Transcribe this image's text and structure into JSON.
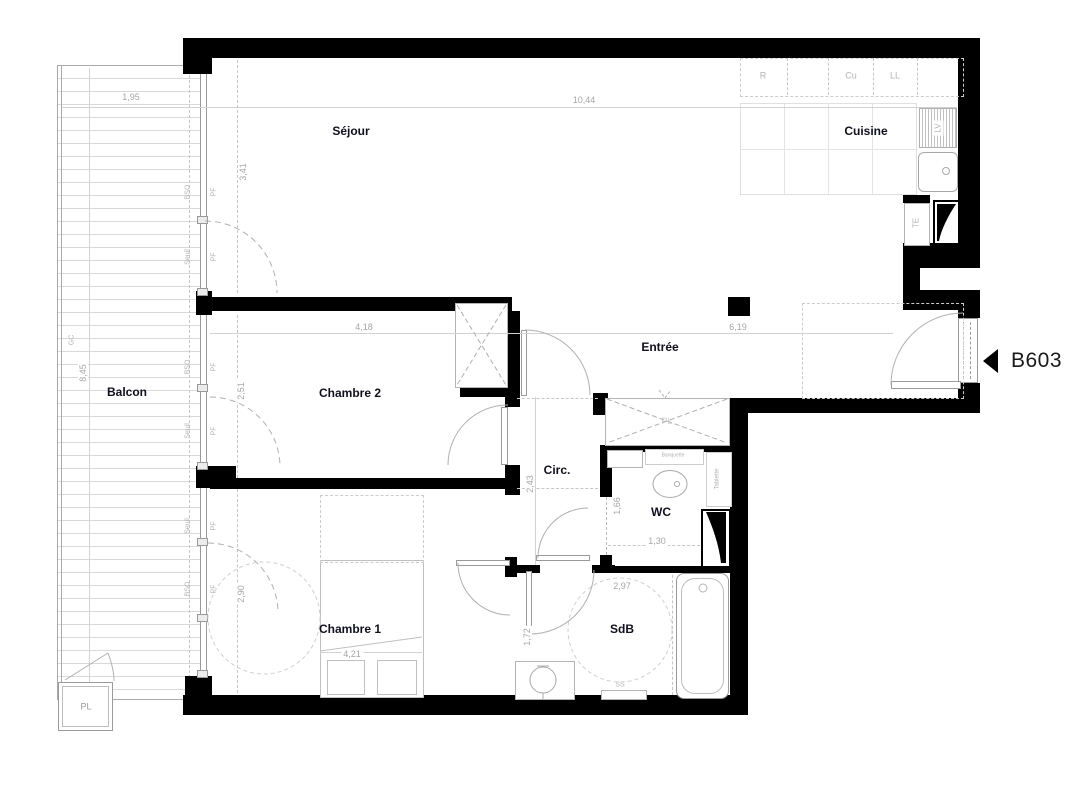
{
  "unit": {
    "id": "B603"
  },
  "rooms": {
    "sejour": {
      "label": "Séjour"
    },
    "cuisine": {
      "label": "Cuisine"
    },
    "balcon": {
      "label": "Balcon"
    },
    "chambre2": {
      "label": "Chambre 2"
    },
    "chambre1": {
      "label": "Chambre 1"
    },
    "entree": {
      "label": "Entrée"
    },
    "circ": {
      "label": "Circ."
    },
    "wc": {
      "label": "WC"
    },
    "sdb": {
      "label": "SdB"
    },
    "pl_balcon": {
      "label": "PL"
    },
    "pl_entree": {
      "label": "PL"
    }
  },
  "dimensions": {
    "balcon_width": "1,95",
    "balcon_length": "8,45",
    "sejour_width": "10,44",
    "sejour_bay": "3,41",
    "chambre2_width": "4,18",
    "chambre2_bay": "2,51",
    "entree_width": "6,19",
    "circ_depth": "2,43",
    "wc_depth": "1,66",
    "wc_width": "1,30",
    "chambre1_bay": "2,90",
    "chambre1_width": "4,21",
    "sdb_width": "2,97",
    "sdb_door": "1,72"
  },
  "annotations": {
    "gc": "GC",
    "bso": "BSO",
    "seuil": "Seuil",
    "pf": "PF",
    "refrigerateur": "R",
    "cuisson": "Cu",
    "lave_linge": "LL",
    "lave_vaisselle": "LV",
    "tableau_electrique": "TE",
    "tablette": "Tablette",
    "banquette": "Banquette",
    "seche_serviettes": "SS"
  },
  "colors": {
    "wall": "#000000",
    "thin_line": "#b4b4b4",
    "dim_text": "#a6a6a6",
    "label_text": "#10101e"
  }
}
